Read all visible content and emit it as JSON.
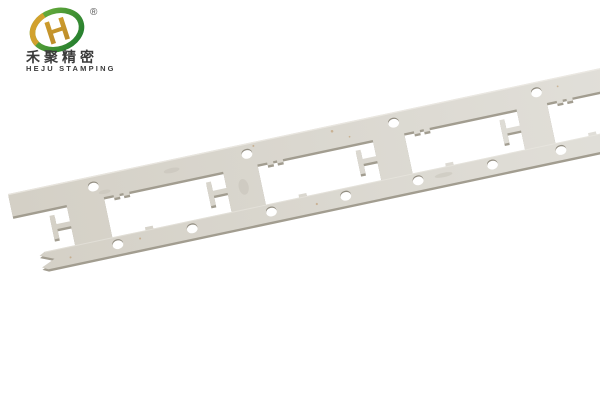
{
  "page": {
    "background_color": "#ffffff"
  },
  "logo": {
    "registered_mark": "®",
    "company_name_zh": "禾聚精密",
    "company_name_en": "HEJU STAMPING",
    "colors": {
      "ring_green_light": "#72b33d",
      "ring_green_dark": "#1e7a2e",
      "gold": "#d2a12d",
      "gold_dark": "#b9882a",
      "text_dark": "#3b3b3b",
      "registered_mark_color": "#555555"
    }
  },
  "photo": {
    "subject": "stamped metal carrier strip with rectangular windows, pilot holes and T-shaped tabs, laid diagonally on white background",
    "colors": {
      "metal_face_near": "#d4d0c6",
      "metal_face_mid": "#dad7cf",
      "metal_face_far": "#e2e0da",
      "metal_edge": "#a29d90",
      "hole_rim": "#938e82",
      "edge_highlight": "#efede7",
      "rust_speck": "#b98d5a",
      "smudge": "#c6c2b8"
    }
  }
}
